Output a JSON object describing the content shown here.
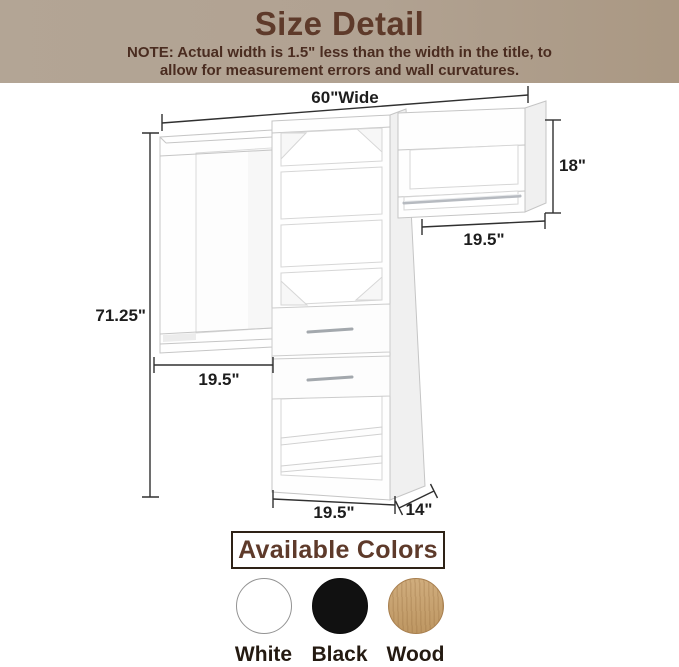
{
  "header": {
    "title": "Size Detail",
    "note_line1": "NOTE: Actual width is 1.5\" less than the width in the title, to",
    "note_line2": "allow for measurement errors and wall curvatures."
  },
  "diagram": {
    "dimensions": {
      "top_width": "60\"Wide",
      "right_unit_height": "18\"",
      "right_unit_width": "19.5\"",
      "total_height": "71.25\"",
      "left_unit_width": "19.5\"",
      "tower_width": "19.5\"",
      "tower_depth": "14\""
    }
  },
  "colors_section": {
    "title": "Available Colors",
    "options": [
      {
        "label": "White",
        "hex": "#ffffff"
      },
      {
        "label": "Black",
        "hex": "#111111"
      },
      {
        "label": "Wood",
        "hex": "#c89f68"
      }
    ]
  },
  "theme": {
    "header_background": "#b1a191",
    "heading_text": "#5e3a2a",
    "note_text": "#4a2c20",
    "dimension_text": "#1d1d1d",
    "dimension_line": "#303030",
    "furniture_line": "#c5c5c5"
  }
}
